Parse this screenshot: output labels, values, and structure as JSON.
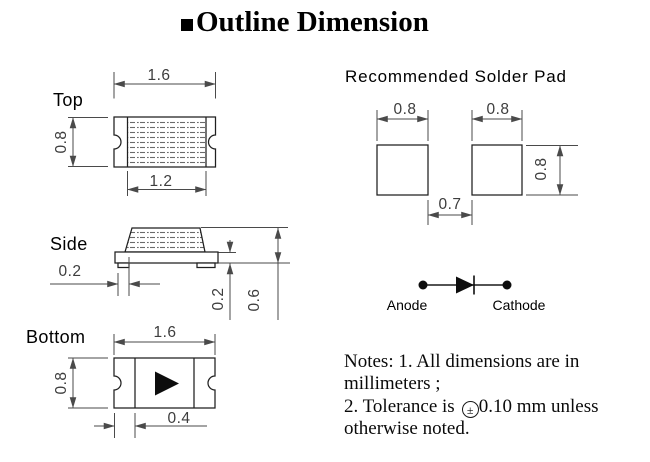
{
  "title": {
    "text": "Outline Dimension"
  },
  "views": {
    "top": {
      "label": "Top",
      "width": "1.6",
      "height": "0.8",
      "inner_width": "1.2"
    },
    "side": {
      "label": "Side",
      "terminal_width": "0.2",
      "base_thickness": "0.2",
      "total_height": "0.6"
    },
    "bottom": {
      "label": "Bottom",
      "width": "1.6",
      "height": "0.8",
      "electrode_width": "0.4"
    }
  },
  "solder_pad": {
    "title": "Recommended Solder Pad",
    "left_pad_width": "0.8",
    "right_pad_width": "0.8",
    "pad_height": "0.8",
    "gap": "0.7"
  },
  "polarity": {
    "anode_label": "Anode",
    "cathode_label": "Cathode"
  },
  "notes": {
    "line1": "Notes: 1. All dimensions are in",
    "line2": "millimeters ;",
    "line3_prefix": "2. Tolerance is",
    "tolerance_symbol": "±",
    "line3_suffix": "0.10 mm unless",
    "line4": "otherwise noted."
  },
  "colors": {
    "outline": "#1f1f1f",
    "dimension_line": "#4a4a4a",
    "dimension_text": "#3d3d3d",
    "text": "#000000"
  }
}
